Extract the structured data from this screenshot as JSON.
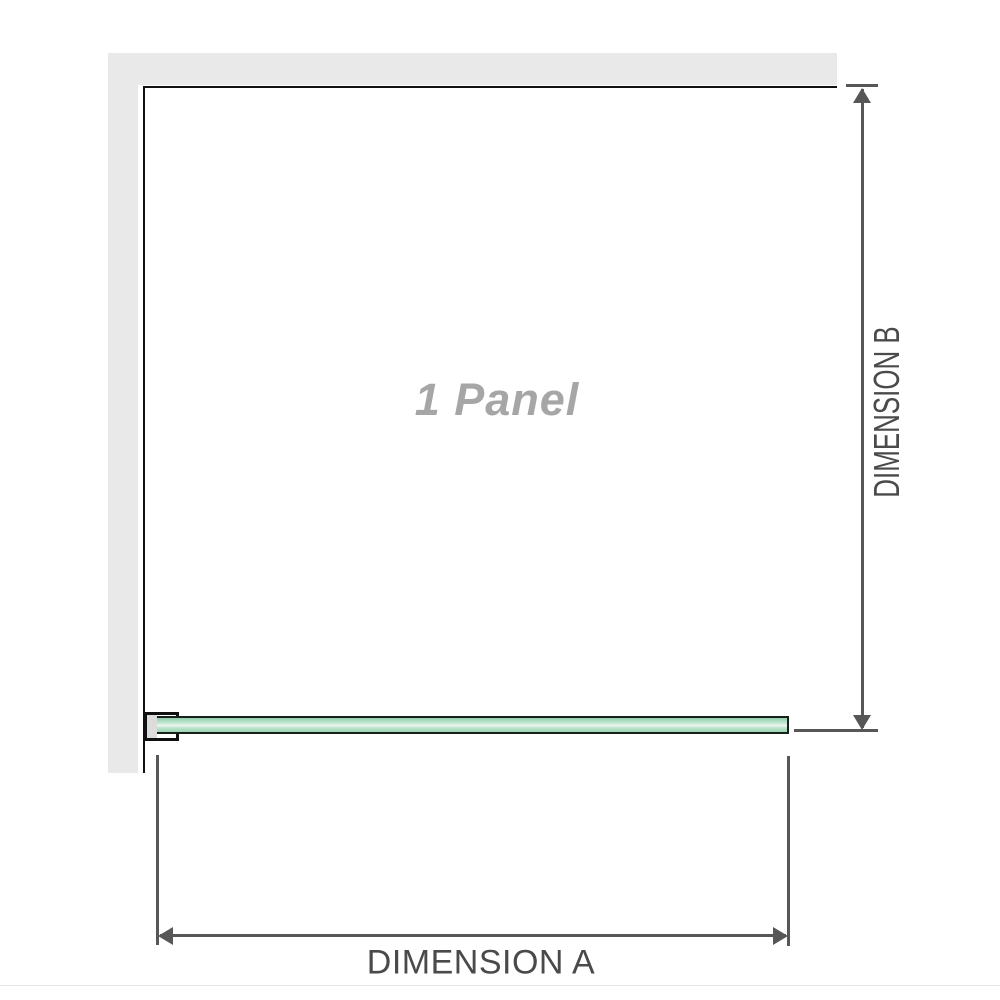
{
  "diagram": {
    "panel_label": "1 Panel",
    "dimension_a": {
      "label": "DIMENSION A"
    },
    "dimension_b": {
      "label": "DIMENSION B"
    }
  },
  "icons": {
    "arrow_up": "triangle-up",
    "arrow_down": "triangle-down",
    "arrow_left": "triangle-left",
    "arrow_right": "triangle-right"
  },
  "colors": {
    "wall": "#e9e9e9",
    "outline": "#101010",
    "dim_line": "#575757",
    "dim_text": "#4a4a4a",
    "panel_label_text": "#a6a6a6",
    "glass_border": "#172019",
    "glass_green": "#8fcfaa",
    "glass_highlight": "#ecf7f0",
    "bracket_fill": "#dcdcdc",
    "page_rule": "#e7e5e2"
  }
}
